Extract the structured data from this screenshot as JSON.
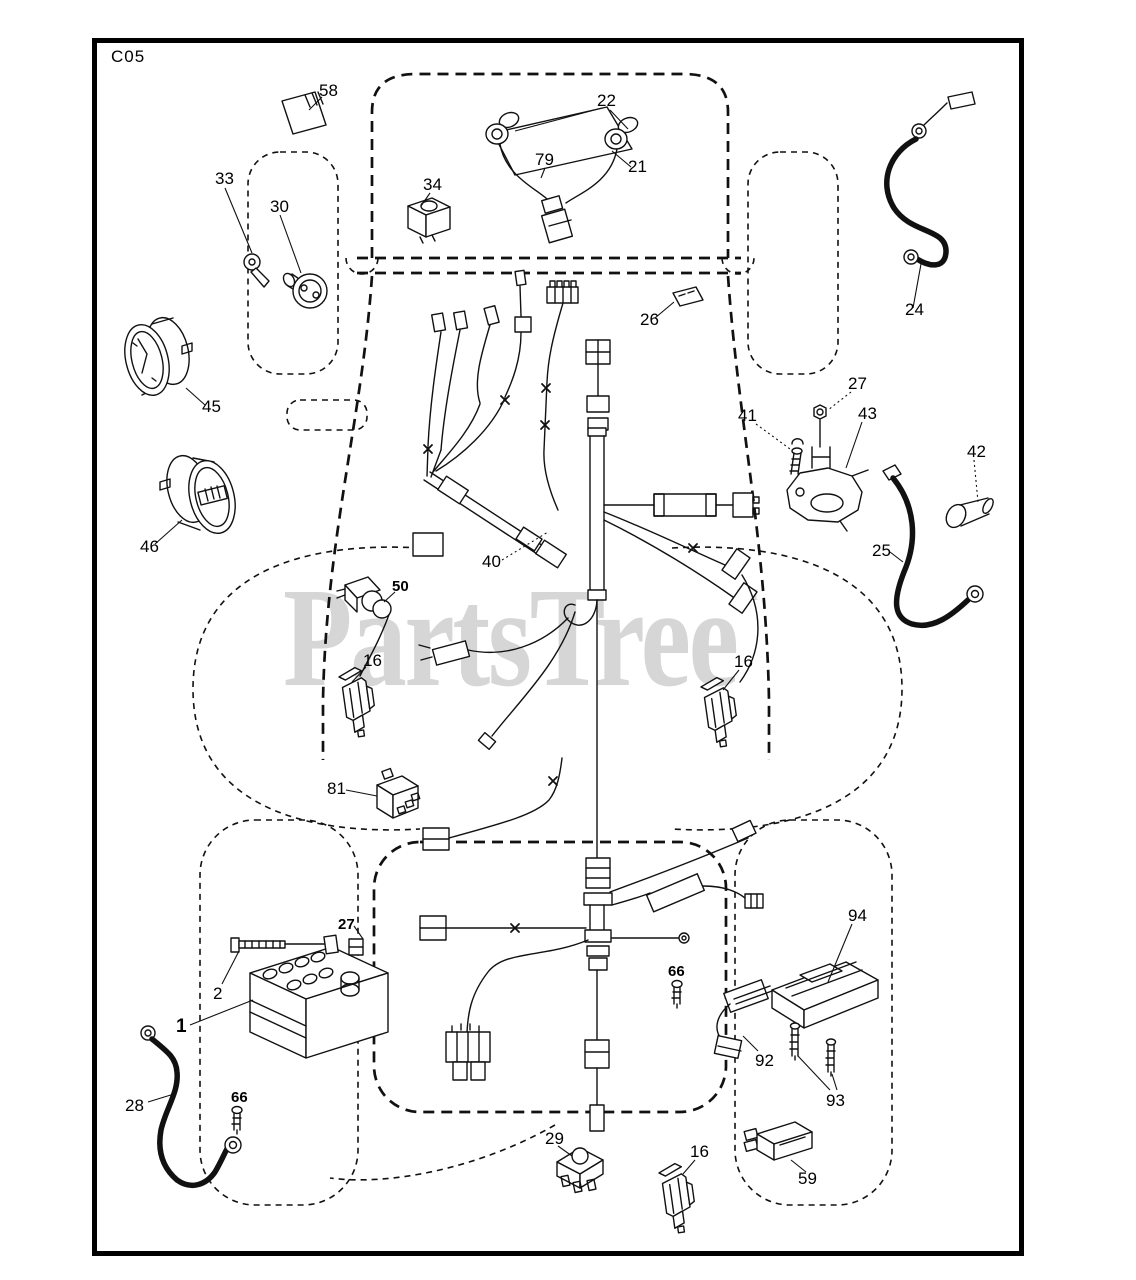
{
  "page_code": "C05",
  "watermark": {
    "text": "PartsTree",
    "tm": "™"
  },
  "colors": {
    "line": "#111111",
    "watermark": "#d6d6d6",
    "background": "#ffffff",
    "frame": "#000000"
  },
  "diagram_title_hint": "Electrical parts diagram",
  "callouts": [
    {
      "label": "58"
    },
    {
      "label": "22"
    },
    {
      "label": "79"
    },
    {
      "label": "21"
    },
    {
      "label": "33"
    },
    {
      "label": "30"
    },
    {
      "label": "34"
    },
    {
      "label": "26"
    },
    {
      "label": "24"
    },
    {
      "label": "45"
    },
    {
      "label": "27"
    },
    {
      "label": "41"
    },
    {
      "label": "43"
    },
    {
      "label": "42"
    },
    {
      "label": "46"
    },
    {
      "label": "25"
    },
    {
      "label": "40"
    },
    {
      "label": "50"
    },
    {
      "label": "16"
    },
    {
      "label": "16"
    },
    {
      "label": "81"
    },
    {
      "label": "27"
    },
    {
      "label": "2"
    },
    {
      "label": "1"
    },
    {
      "label": "66"
    },
    {
      "label": "94"
    },
    {
      "label": "92"
    },
    {
      "label": "93"
    },
    {
      "label": "28"
    },
    {
      "label": "66"
    },
    {
      "label": "29"
    },
    {
      "label": "16"
    },
    {
      "label": "59"
    }
  ]
}
